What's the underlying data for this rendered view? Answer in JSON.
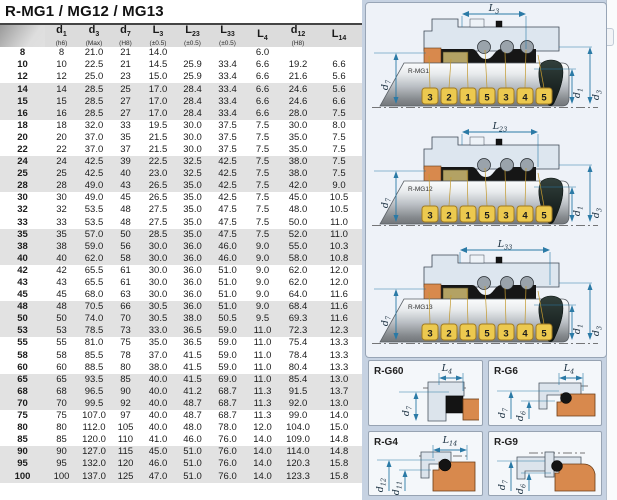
{
  "title": "R-MG1 / MG12 / MG13",
  "colors": {
    "panel_background": "#c6d2e2",
    "diagram_panel": "#eef2f8",
    "dimension_line": "#2b7aa6",
    "callout_fill": "#ecc94f",
    "seat_elastomer": "#d8894d",
    "header_background": "#dcdcdc",
    "row_stripe": "#e2e2e2"
  },
  "table": {
    "columns": [
      {
        "letter": "",
        "sub": "",
        "note": ""
      },
      {
        "letter": "d",
        "sub": "1",
        "note": "(h6)"
      },
      {
        "letter": "d",
        "sub": "3",
        "note": "(Max)"
      },
      {
        "letter": "d",
        "sub": "7",
        "note": "(H8)"
      },
      {
        "letter": "L",
        "sub": "3",
        "note": "(±0.5)"
      },
      {
        "letter": "L",
        "sub": "23",
        "note": "(±0.5)"
      },
      {
        "letter": "L",
        "sub": "33",
        "note": "(±0.5)"
      },
      {
        "letter": "L",
        "sub": "4",
        "note": ""
      },
      {
        "letter": "d",
        "sub": "12",
        "note": "(H8)"
      },
      {
        "letter": "L",
        "sub": "14",
        "note": ""
      }
    ],
    "rows": [
      [
        "8",
        "8",
        "21.0",
        "21",
        "14.0",
        "",
        "",
        "6.0",
        "",
        ""
      ],
      [
        "10",
        "10",
        "22.5",
        "21",
        "14.5",
        "25.9",
        "33.4",
        "6.6",
        "19.2",
        "6.6"
      ],
      [
        "12",
        "12",
        "25.0",
        "23",
        "15.0",
        "25.9",
        "33.4",
        "6.6",
        "21.6",
        "5.6"
      ],
      [
        "14",
        "14",
        "28.5",
        "25",
        "17.0",
        "28.4",
        "33.4",
        "6.6",
        "24.6",
        "5.6"
      ],
      [
        "15",
        "15",
        "28.5",
        "27",
        "17.0",
        "28.4",
        "33.4",
        "6.6",
        "24.6",
        "6.6"
      ],
      [
        "16",
        "16",
        "28.5",
        "27",
        "17.0",
        "28.4",
        "33.4",
        "6.6",
        "28.0",
        "7.5"
      ],
      [
        "18",
        "18",
        "32.0",
        "33",
        "19.5",
        "30.0",
        "37.5",
        "7.5",
        "30.0",
        "8.0"
      ],
      [
        "20",
        "20",
        "37.0",
        "35",
        "21.5",
        "30.0",
        "37.5",
        "7.5",
        "35.0",
        "7.5"
      ],
      [
        "22",
        "22",
        "37.0",
        "37",
        "21.5",
        "30.0",
        "37.5",
        "7.5",
        "35.0",
        "7.5"
      ],
      [
        "24",
        "24",
        "42.5",
        "39",
        "22.5",
        "32.5",
        "42.5",
        "7.5",
        "38.0",
        "7.5"
      ],
      [
        "25",
        "25",
        "42.5",
        "40",
        "23.0",
        "32.5",
        "42.5",
        "7.5",
        "38.0",
        "7.5"
      ],
      [
        "28",
        "28",
        "49.0",
        "43",
        "26.5",
        "35.0",
        "42.5",
        "7.5",
        "42.0",
        "9.0"
      ],
      [
        "30",
        "30",
        "49.0",
        "45",
        "26.5",
        "35.0",
        "42.5",
        "7.5",
        "45.0",
        "10.5"
      ],
      [
        "32",
        "32",
        "53.5",
        "48",
        "27.5",
        "35.0",
        "47.5",
        "7.5",
        "48.0",
        "10.5"
      ],
      [
        "33",
        "33",
        "53.5",
        "48",
        "27.5",
        "35.0",
        "47.5",
        "7.5",
        "50.0",
        "11.0"
      ],
      [
        "35",
        "35",
        "57.0",
        "50",
        "28.5",
        "35.0",
        "47.5",
        "7.5",
        "52.0",
        "11.0"
      ],
      [
        "38",
        "38",
        "59.0",
        "56",
        "30.0",
        "36.0",
        "46.0",
        "9.0",
        "55.0",
        "10.3"
      ],
      [
        "40",
        "40",
        "62.0",
        "58",
        "30.0",
        "36.0",
        "46.0",
        "9.0",
        "58.0",
        "10.8"
      ],
      [
        "42",
        "42",
        "65.5",
        "61",
        "30.0",
        "36.0",
        "51.0",
        "9.0",
        "62.0",
        "12.0"
      ],
      [
        "43",
        "43",
        "65.5",
        "61",
        "30.0",
        "36.0",
        "51.0",
        "9.0",
        "62.0",
        "12.0"
      ],
      [
        "45",
        "45",
        "68.0",
        "63",
        "30.0",
        "36.0",
        "51.0",
        "9.0",
        "64.0",
        "11.6"
      ],
      [
        "48",
        "48",
        "70.5",
        "66",
        "30.5",
        "36.0",
        "51.0",
        "9.0",
        "68.4",
        "11.6"
      ],
      [
        "50",
        "50",
        "74.0",
        "70",
        "30.5",
        "38.0",
        "50.5",
        "9.5",
        "69.3",
        "11.6"
      ],
      [
        "53",
        "53",
        "78.5",
        "73",
        "33.0",
        "36.5",
        "59.0",
        "11.0",
        "72.3",
        "12.3"
      ],
      [
        "55",
        "55",
        "81.0",
        "75",
        "35.0",
        "36.5",
        "59.0",
        "11.0",
        "75.4",
        "13.3"
      ],
      [
        "58",
        "58",
        "85.5",
        "78",
        "37.0",
        "41.5",
        "59.0",
        "11.0",
        "78.4",
        "13.3"
      ],
      [
        "60",
        "60",
        "88.5",
        "80",
        "38.0",
        "41.5",
        "59.0",
        "11.0",
        "80.4",
        "13.3"
      ],
      [
        "65",
        "65",
        "93.5",
        "85",
        "40.0",
        "41.5",
        "69.0",
        "11.0",
        "85.4",
        "13.0"
      ],
      [
        "68",
        "68",
        "96.5",
        "90",
        "40.0",
        "41.2",
        "68.7",
        "11.3",
        "91.5",
        "13.7"
      ],
      [
        "70",
        "70",
        "99.5",
        "92",
        "40.0",
        "48.7",
        "68.7",
        "11.3",
        "92.0",
        "13.0"
      ],
      [
        "75",
        "75",
        "107.0",
        "97",
        "40.0",
        "48.7",
        "68.7",
        "11.3",
        "99.0",
        "14.0"
      ],
      [
        "80",
        "80",
        "112.0",
        "105",
        "40.0",
        "48.0",
        "78.0",
        "12.0",
        "104.0",
        "15.0"
      ],
      [
        "85",
        "85",
        "120.0",
        "110",
        "41.0",
        "46.0",
        "76.0",
        "14.0",
        "109.0",
        "14.8"
      ],
      [
        "90",
        "90",
        "127.0",
        "115",
        "45.0",
        "51.0",
        "76.0",
        "14.0",
        "114.0",
        "14.8"
      ],
      [
        "95",
        "95",
        "132.0",
        "120",
        "46.0",
        "51.0",
        "76.0",
        "14.0",
        "120.3",
        "15.8"
      ],
      [
        "100",
        "100",
        "137.0",
        "125",
        "47.0",
        "51.0",
        "76.0",
        "14.0",
        "123.3",
        "15.8"
      ]
    ]
  },
  "diagrams": [
    {
      "label": "R-MG1",
      "top_dim": {
        "letter": "L",
        "sub": "3"
      },
      "arrow": {
        "x1": 96,
        "x2": 160
      },
      "left_dim": {
        "letter": "d",
        "sub": "7"
      },
      "right_dim_inner": {
        "letter": "d",
        "sub": "1"
      },
      "right_dim_outer": {
        "letter": "d",
        "sub": "3"
      },
      "callouts": [
        "3",
        "2",
        "1",
        "5",
        "3",
        "4",
        "5"
      ]
    },
    {
      "label": "R-MG12",
      "top_dim": {
        "letter": "L",
        "sub": "23"
      },
      "arrow": {
        "x1": 96,
        "x2": 172
      },
      "left_dim": {
        "letter": "d",
        "sub": "7"
      },
      "right_dim_inner": {
        "letter": "d",
        "sub": "1"
      },
      "right_dim_outer": {
        "letter": "d",
        "sub": "3"
      },
      "callouts": [
        "3",
        "2",
        "1",
        "5",
        "3",
        "4",
        "5"
      ]
    },
    {
      "label": "R-MG13",
      "top_dim": {
        "letter": "L",
        "sub": "33"
      },
      "arrow": {
        "x1": 94,
        "x2": 184
      },
      "left_dim": {
        "letter": "d",
        "sub": "7"
      },
      "right_dim_inner": {
        "letter": "d",
        "sub": "1"
      },
      "right_dim_outer": {
        "letter": "d",
        "sub": "3"
      },
      "callouts": [
        "3",
        "2",
        "1",
        "5",
        "3",
        "4",
        "5"
      ]
    }
  ],
  "seat_diagrams": [
    {
      "label": "R-G60",
      "top_dim": {
        "letter": "L",
        "sub": "4"
      },
      "left_dims": [
        {
          "letter": "d",
          "sub": "7"
        }
      ]
    },
    {
      "label": "R-G6",
      "top_dim": {
        "letter": "L",
        "sub": "4"
      },
      "left_dims": [
        {
          "letter": "d",
          "sub": "7"
        },
        {
          "letter": "d",
          "sub": "6"
        }
      ]
    },
    {
      "label": "R-G4",
      "top_dim": {
        "letter": "L",
        "sub": "14"
      },
      "left_dims": [
        {
          "letter": "d",
          "sub": "12"
        },
        {
          "letter": "d",
          "sub": "11"
        }
      ]
    },
    {
      "label": "R-G9",
      "top_dim": null,
      "left_dims": [
        {
          "letter": "d",
          "sub": "7"
        },
        {
          "letter": "d",
          "sub": "6"
        }
      ]
    }
  ]
}
